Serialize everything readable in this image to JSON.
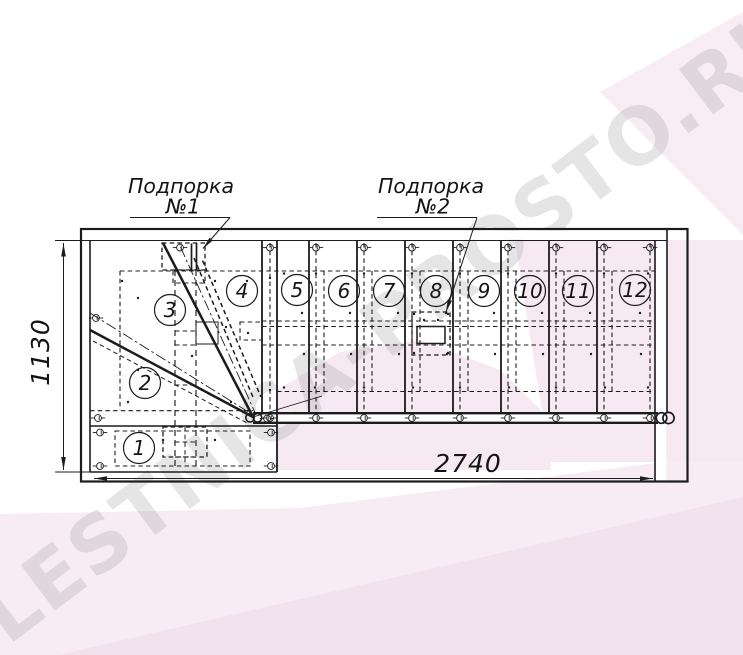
{
  "drawing": {
    "title_labels": {
      "support1_line1": "Подпорка",
      "support1_line2": "№1",
      "support2_line1": "Подпорка",
      "support2_line2": "№2"
    },
    "dimensions": {
      "height": "1130",
      "width": "2740"
    },
    "steps": [
      {
        "label": "1"
      },
      {
        "label": "2"
      },
      {
        "label": "3"
      },
      {
        "label": "4"
      },
      {
        "label": "5"
      },
      {
        "label": "6"
      },
      {
        "label": "7"
      },
      {
        "label": "8"
      },
      {
        "label": "9"
      },
      {
        "label": "10"
      },
      {
        "label": "11"
      },
      {
        "label": "12"
      }
    ]
  },
  "watermark": {
    "text": "LESTNICA-PROSTO.RU"
  },
  "colors": {
    "paper": "#ffffff",
    "ink": "#1c1c1c",
    "pink_overlay": "#f6e9f2",
    "pink_overlay_deep": "#f0dfeb",
    "watermark_gray": "#9c9c9c"
  }
}
